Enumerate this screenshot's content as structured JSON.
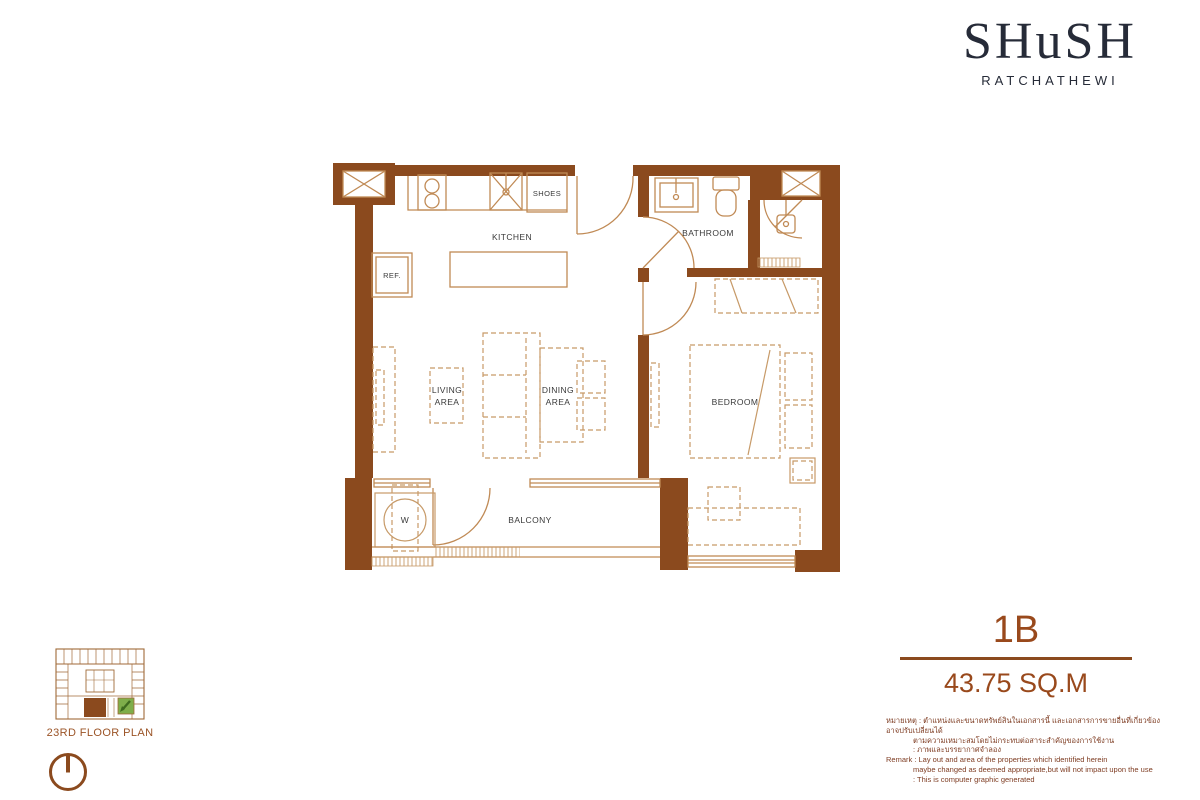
{
  "logo": {
    "brand": "SHuSH",
    "location": "RATCHATHEWI"
  },
  "floor_plan": {
    "labels": {
      "kitchen": "KITCHEN",
      "shoes": "SHOES",
      "ref": "REF.",
      "bathroom": "BATHROOM",
      "living_line1": "LIVING",
      "living_line2": "AREA",
      "dining_line1": "DINING",
      "dining_line2": "AREA",
      "bedroom": "BEDROOM",
      "balcony": "BALCONY",
      "washer": "W"
    }
  },
  "key_plan": {
    "caption": "23RD FLOOR PLAN"
  },
  "unit_info": {
    "unit_type": "1B",
    "area": "43.75 SQ.M"
  },
  "remark": {
    "lines": [
      "หมายเหตุ : ตำแหน่งและขนาดทรัพย์สินในเอกสารนี้ และเอกสารการขายอื่นที่เกี่ยวข้อง อาจปรับเปลี่ยนได้",
      "ตามความเหมาะสมโดยไม่กระทบต่อสาระสำคัญของการใช้งาน",
      ": ภาพและบรรยากาศจำลอง",
      "Remark : Lay out and area of the properties which identified herein",
      "maybe changed as deemed appropriate,but will not impact upon the use",
      ": This is computer graphic generated"
    ]
  },
  "colors": {
    "wall_brown": "#8b4a1e",
    "fixture_tan": "#c08a55",
    "furniture_tan": "#c79a68",
    "label_gray": "#3a3a3a",
    "accent_brown": "#99491c",
    "logo_navy": "#262b38",
    "keyplan_green": "#7fae4a",
    "arrow_green": "#3f6b1f"
  }
}
